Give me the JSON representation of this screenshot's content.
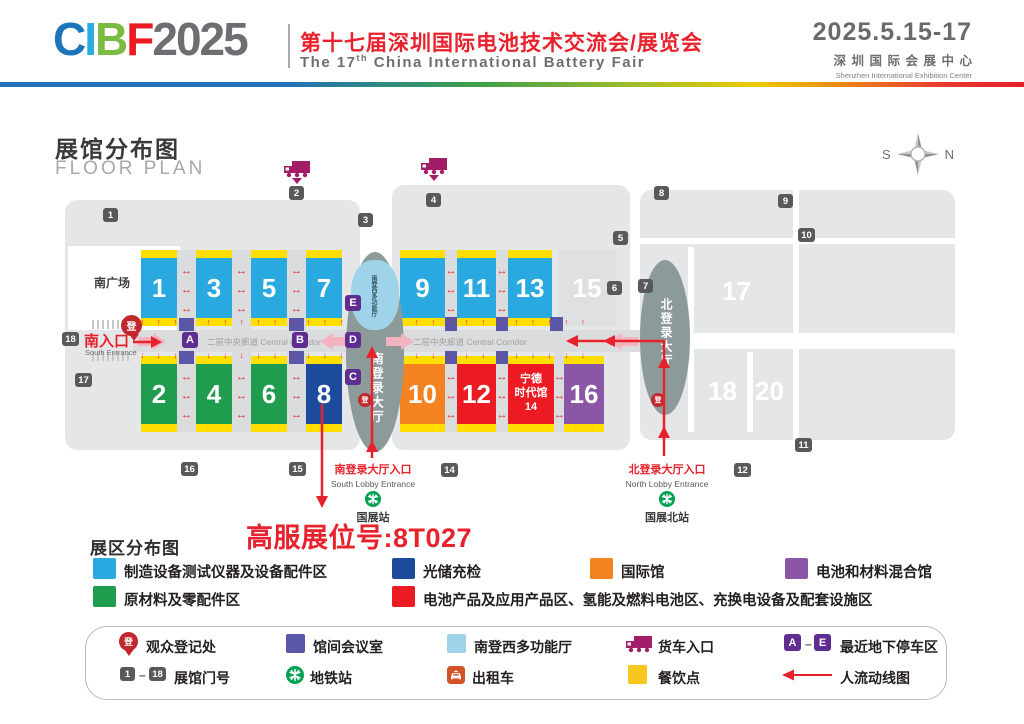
{
  "header": {
    "logo_c": "C",
    "logo_i": "I",
    "logo_b": "B",
    "logo_f": "F",
    "logo_year": "2025",
    "logo_colors": {
      "c": "#1B75BB",
      "i": "#29ABE2",
      "b": "#7CBB42",
      "f": "#EC1B23",
      "year": "#6D6E71"
    },
    "title_zh": "第十七届深圳国际电池技术交流会/展览会",
    "title_en_prefix": "The 17",
    "title_en_sup": "th",
    "title_en_suffix": " China International Battery Fair",
    "date": "2025.5.15-17",
    "venue_zh": "深圳国际会展中心",
    "venue_en": "Shenzhen International Exhibition Center"
  },
  "floorplan": {
    "title_zh": "展馆分布图",
    "title_en": "FLOOR PLAN",
    "compass_w": "S",
    "compass_e": "N",
    "south_square": "南广场",
    "south_entrance_zh": "南入口",
    "south_entrance_en": "South Entrance",
    "corridor_label": "二层中央廊道 Central Corridor",
    "south_lobby": "南登录大厅",
    "north_lobby": "北登录大厅",
    "multi_hall": "南登西多功能厅",
    "register_glyph": "登",
    "halls": {
      "h1": "1",
      "h2": "2",
      "h3": "3",
      "h4": "4",
      "h5": "5",
      "h6": "6",
      "h7": "7",
      "h8": "8",
      "h9": "9",
      "h10": "10",
      "h11": "11",
      "h12": "12",
      "h13": "13",
      "h14": "宁德\n时代馆\n14",
      "h15": "15",
      "h16": "16",
      "h17": "17",
      "h18": "18",
      "h20": "20"
    },
    "gates": {
      "g1": "1",
      "g2": "2",
      "g3": "3",
      "g4": "4",
      "g5": "5",
      "g6": "6",
      "g7": "7",
      "g8": "8",
      "g9": "9",
      "g10": "10",
      "g11": "11",
      "g12": "12",
      "g14": "14",
      "g15": "15",
      "g16": "16",
      "g17": "17",
      "g18": "18"
    },
    "parking": {
      "a": "A",
      "b": "B",
      "c": "C",
      "d": "D",
      "e": "E"
    },
    "arrows": {
      "up": "↑ ↑ ↑ ↑ ↑ ↑ ↑ ↑ ↑ ↑ ↑ ↑ ↑ ↑ ↑ ↑",
      "down": "↓ ↓ ↓ ↓ ↓ ↓ ↓ ↓ ↓ ↓ ↓ ↓ ↓ ↓ ↓ ↓",
      "h3": "↔\n↔\n↔"
    },
    "south_lobby_entrance_zh": "南登录大厅入口",
    "south_lobby_entrance_en": "South Lobby Entrance",
    "south_station": "国展站",
    "north_lobby_entrance_zh": "北登录大厅入口",
    "north_lobby_entrance_en": "North Lobby Entrance",
    "north_station": "国展北站",
    "booth_callout": "高服展位号:8T027"
  },
  "zones_legend": {
    "title": "展区分布图",
    "items": [
      {
        "color": "#29A9E0",
        "label": "制造设备测试仪器及设备配件区"
      },
      {
        "color": "#1C4B9C",
        "label": "光储充检"
      },
      {
        "color": "#F58220",
        "label": "国际馆"
      },
      {
        "color": "#8A56A5",
        "label": "电池和材料混合馆"
      },
      {
        "color": "#1F9C4D",
        "label": "原材料及零配件区"
      },
      {
        "color": "#EC1B23",
        "label": "电池产品及应用产品区、氢能及燃料电池区、充换电设备及配套设施区"
      }
    ]
  },
  "symbols_legend": {
    "registration": "观众登记处",
    "meeting": "馆间会议室",
    "multi": "南登西多功能厅",
    "truck": "货车入口",
    "parking_a": "A",
    "parking_e": "E",
    "dash": "–",
    "parking_label": "最近地下停车区",
    "gate_1": "1",
    "gate_18": "18",
    "gate_label": "展馆门号",
    "metro": "地铁站",
    "taxi": "出租车",
    "food": "餐饮点",
    "flow": "人流动线图"
  },
  "symbol_colors": {
    "meeting": "#5B57A8",
    "multi": "#9FD3EA",
    "food": "#F6C71E",
    "truck": "#A21C68",
    "metro": "#00A053",
    "taxi": "#D35227",
    "parking": "#5F2C91",
    "gate": "#58595A",
    "registration": "#C1272D",
    "flow_red": "#E8222D",
    "pink": "#F3B3BF",
    "lobby": "#8C9B99",
    "yellow": "#FFDE00"
  }
}
